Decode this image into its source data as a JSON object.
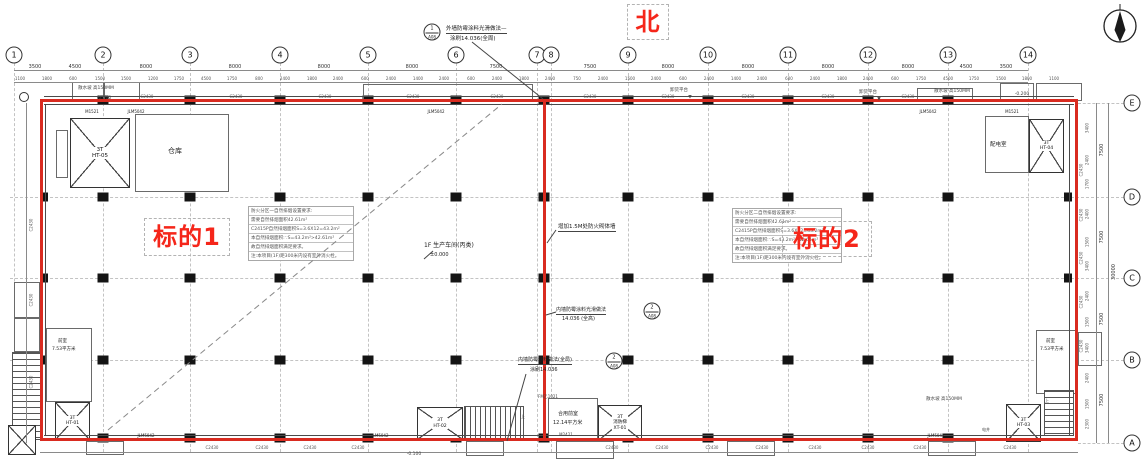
{
  "colors": {
    "red_line": "#d92b20",
    "red_text": "#f5261a"
  },
  "annotations": {
    "north": "北",
    "target1": "标的1",
    "target2": "标的2"
  },
  "callouts": {
    "c1": {
      "num": "1",
      "ref": "A08",
      "line1": "外墙防霉涂料光滑做法—",
      "line2": "涂刷14.036(全周)"
    },
    "c2": {
      "num": "2",
      "ref": "A08",
      "line1": "内墙防霉涂料光滑做法",
      "line2": "14.036 (全高)"
    },
    "c3": {
      "num": "2",
      "ref": "A08",
      "line1": "内墙防霉涂料做法(全局)",
      "line2": "涂刷14.036"
    },
    "firewall_note": "增加1.5M处防火砌体墙"
  },
  "hall": {
    "label": "1F 生产车间(丙类)",
    "elevation": "±0.000"
  },
  "notes": {
    "zone1": {
      "rows": [
        "防火分区一自然排烟设置要求:",
        "需要自然排烟面积42.61m²",
        "C2415P自然排烟面积S=3.6X12=43.2m²",
        "本自然排烟面积:∵S=43.2m²>42.61m²",
        "故自然排烟面积满足要求。",
        "注:本项目(1F)距300米内设有室外消火栓。"
      ]
    },
    "zone2": {
      "rows": [
        "防火分区二自然排烟设置要求:",
        "需要自然排烟面积42.61m²",
        "C2415P自然排烟面积S=3.6X12=43.2m²",
        "本自然排烟面积:∵S=43.2m²>42.61m²",
        "故自然排烟面积满足要求。",
        "注:本项目(1F)距300米内设有室外消火栓。"
      ]
    }
  },
  "rooms": {
    "room_tl": "仓库",
    "room_tr": "配电室",
    "front_bl_1": "前室",
    "front_bl_2": "7.53平方米",
    "front_bc_1": "合用前室",
    "front_bc_2": "12.14平方米",
    "front_br_1": "前室",
    "front_br_2": "7.53平方米",
    "elev_tl_1": "3T",
    "elev_tl_2": "HT-05",
    "elev_tr_1": "3T",
    "elev_tr_2": "HT-04",
    "elev_bl_1": "3T",
    "elev_bl_2": "HT-01",
    "elev_bc_1": "3T",
    "elev_bc_2": "HT-02",
    "elev_fire_1": "3T",
    "elev_fire_2": "消防梯",
    "elev_fire_3": "XT-01",
    "elev_br_1": "3T",
    "elev_br_2": "HT-03"
  },
  "dim_totals": {
    "right_total": "30000"
  },
  "repeats": {
    "grid_top": [
      {
        "t": "1",
        "x": 14
      },
      {
        "t": "2",
        "x": 103
      },
      {
        "t": "3",
        "x": 190
      },
      {
        "t": "4",
        "x": 280
      },
      {
        "t": "5",
        "x": 368
      },
      {
        "t": "6",
        "x": 456
      },
      {
        "t": "7",
        "x": 537
      },
      {
        "t": "8",
        "x": 551
      },
      {
        "t": "9",
        "x": 628
      },
      {
        "t": "10",
        "x": 708
      },
      {
        "t": "11",
        "x": 788
      },
      {
        "t": "12",
        "x": 868
      },
      {
        "t": "13",
        "x": 948
      },
      {
        "t": "14",
        "x": 1028
      }
    ],
    "grid_right": [
      {
        "t": "E",
        "y": 103
      },
      {
        "t": "D",
        "y": 197
      },
      {
        "t": "C",
        "y": 278
      },
      {
        "t": "B",
        "y": 360
      },
      {
        "t": "A",
        "y": 443
      }
    ],
    "dims_top1": [
      {
        "t": "3500",
        "x": 35
      },
      {
        "t": "4500",
        "x": 75
      },
      {
        "t": "8000",
        "x": 146
      },
      {
        "t": "8000",
        "x": 235
      },
      {
        "t": "8000",
        "x": 324
      },
      {
        "t": "8000",
        "x": 412
      },
      {
        "t": "7500",
        "x": 496
      },
      {
        "t": "7500",
        "x": 590
      },
      {
        "t": "8000",
        "x": 668
      },
      {
        "t": "8000",
        "x": 748
      },
      {
        "t": "8000",
        "x": 828
      },
      {
        "t": "8000",
        "x": 908
      },
      {
        "t": "4500",
        "x": 966
      },
      {
        "t": "3500",
        "x": 1006
      }
    ],
    "dims_top2": [
      {
        "t": "1100",
        "x": 20
      },
      {
        "t": "1800",
        "x": 47
      },
      {
        "t": "600",
        "x": 73
      },
      {
        "t": "1500",
        "x": 100
      },
      {
        "t": "1500",
        "x": 126
      },
      {
        "t": "1200",
        "x": 153
      },
      {
        "t": "1750",
        "x": 179
      },
      {
        "t": "4500",
        "x": 206
      },
      {
        "t": "1750",
        "x": 232
      },
      {
        "t": "800",
        "x": 259
      },
      {
        "t": "2400",
        "x": 285
      },
      {
        "t": "1800",
        "x": 312
      },
      {
        "t": "2400",
        "x": 338
      },
      {
        "t": "600",
        "x": 365
      },
      {
        "t": "2400",
        "x": 391
      },
      {
        "t": "1400",
        "x": 418
      },
      {
        "t": "2400",
        "x": 444
      },
      {
        "t": "600",
        "x": 471
      },
      {
        "t": "2400",
        "x": 497
      },
      {
        "t": "1800",
        "x": 524
      },
      {
        "t": "2400",
        "x": 550
      },
      {
        "t": "750",
        "x": 577
      },
      {
        "t": "2400",
        "x": 603
      },
      {
        "t": "1500",
        "x": 630
      },
      {
        "t": "2400",
        "x": 656
      },
      {
        "t": "600",
        "x": 683
      },
      {
        "t": "2400",
        "x": 709
      },
      {
        "t": "1400",
        "x": 736
      },
      {
        "t": "2400",
        "x": 762
      },
      {
        "t": "600",
        "x": 789
      },
      {
        "t": "2400",
        "x": 815
      },
      {
        "t": "1800",
        "x": 842
      },
      {
        "t": "2400",
        "x": 868
      },
      {
        "t": "600",
        "x": 895
      },
      {
        "t": "1750",
        "x": 921
      },
      {
        "t": "4500",
        "x": 948
      },
      {
        "t": "1750",
        "x": 974
      },
      {
        "t": "1500",
        "x": 1001
      },
      {
        "t": "1800",
        "x": 1027
      },
      {
        "t": "1100",
        "x": 1054
      }
    ],
    "dims_right": [
      {
        "t": "7500",
        "y": 150
      },
      {
        "t": "7500",
        "y": 237
      },
      {
        "t": "7500",
        "y": 319
      },
      {
        "t": "7500",
        "y": 400
      }
    ],
    "dims_right_sub": [
      {
        "t": "3400",
        "y": 128
      },
      {
        "t": "2400",
        "y": 160
      },
      {
        "t": "1700",
        "y": 184
      },
      {
        "t": "2400",
        "y": 214
      },
      {
        "t": "1500",
        "y": 242
      },
      {
        "t": "3400",
        "y": 266
      },
      {
        "t": "2400",
        "y": 296
      },
      {
        "t": "1500",
        "y": 322
      },
      {
        "t": "3400",
        "y": 348
      },
      {
        "t": "2400",
        "y": 378
      },
      {
        "t": "1500",
        "y": 404
      },
      {
        "t": "2300",
        "y": 424
      }
    ],
    "win_top": [
      {
        "t": "C2430",
        "x": 147
      },
      {
        "t": "C2430",
        "x": 236
      },
      {
        "t": "C2430",
        "x": 325
      },
      {
        "t": "C2430",
        "x": 413
      },
      {
        "t": "C2430",
        "x": 497
      },
      {
        "t": "C2430",
        "x": 590
      },
      {
        "t": "C2430",
        "x": 668
      },
      {
        "t": "C2430",
        "x": 748
      },
      {
        "t": "C2430",
        "x": 828
      },
      {
        "t": "C2430",
        "x": 908
      }
    ],
    "win_bottom": [
      {
        "t": "C2430",
        "x": 212
      },
      {
        "t": "C2430",
        "x": 262
      },
      {
        "t": "C2430",
        "x": 310
      },
      {
        "t": "C2430",
        "x": 358
      },
      {
        "t": "C2430",
        "x": 612
      },
      {
        "t": "C2430",
        "x": 662
      },
      {
        "t": "C2430",
        "x": 712
      },
      {
        "t": "C2430",
        "x": 762
      },
      {
        "t": "C2430",
        "x": 815
      },
      {
        "t": "C2430",
        "x": 868
      },
      {
        "t": "C2430",
        "x": 920
      },
      {
        "t": "C2430",
        "x": 1010
      }
    ],
    "win_left": [
      {
        "t": "C2430",
        "y": 225
      },
      {
        "t": "C2430",
        "y": 300
      },
      {
        "t": "C2430",
        "y": 382
      }
    ],
    "win_right": [
      {
        "t": "C2430",
        "y": 170
      },
      {
        "t": "C2430",
        "y": 215
      },
      {
        "t": "C2430",
        "y": 258
      },
      {
        "t": "C2430",
        "y": 302
      },
      {
        "t": "C2430",
        "y": 346
      }
    ],
    "door_marks": [
      {
        "t": "M1521",
        "x": 92,
        "y": 109
      },
      {
        "t": "JLM5042",
        "x": 136,
        "y": 109
      },
      {
        "t": "JLM5042",
        "x": 436,
        "y": 109
      },
      {
        "t": "JLM5042",
        "x": 928,
        "y": 109
      },
      {
        "t": "M1521",
        "x": 1012,
        "y": 109
      },
      {
        "t": "JLM5042",
        "x": 146,
        "y": 433
      },
      {
        "t": "JLM5042",
        "x": 380,
        "y": 433
      },
      {
        "t": "JLM5042",
        "x": 936,
        "y": 433
      }
    ],
    "site_labels": [
      {
        "t": "散水坡 高150MM",
        "x": 96,
        "y": 85
      },
      {
        "t": "-0.200",
        "x": 104,
        "y": 96
      },
      {
        "t": "卸货平台",
        "x": 679,
        "y": 87
      },
      {
        "t": "▼",
        "x": 690,
        "y": 95
      },
      {
        "t": "卸货平台",
        "x": 868,
        "y": 89
      },
      {
        "t": "▼",
        "x": 879,
        "y": 97
      },
      {
        "t": "散水坡 高150MM",
        "x": 952,
        "y": 88
      },
      {
        "t": "-0.200",
        "x": 1022,
        "y": 92
      },
      {
        "t": "散水坡 高150MM",
        "x": 944,
        "y": 396
      },
      {
        "t": "-0.100",
        "x": 414,
        "y": 452
      }
    ],
    "micro_marks": [
      {
        "t": "FM乙1021",
        "x": 548,
        "y": 394
      },
      {
        "t": "M2421",
        "x": 566,
        "y": 432
      },
      {
        "t": "电井",
        "x": 986,
        "y": 427
      },
      {
        "t": "上",
        "x": 523,
        "y": 414
      },
      {
        "t": "上",
        "x": 1047,
        "y": 398
      }
    ]
  }
}
